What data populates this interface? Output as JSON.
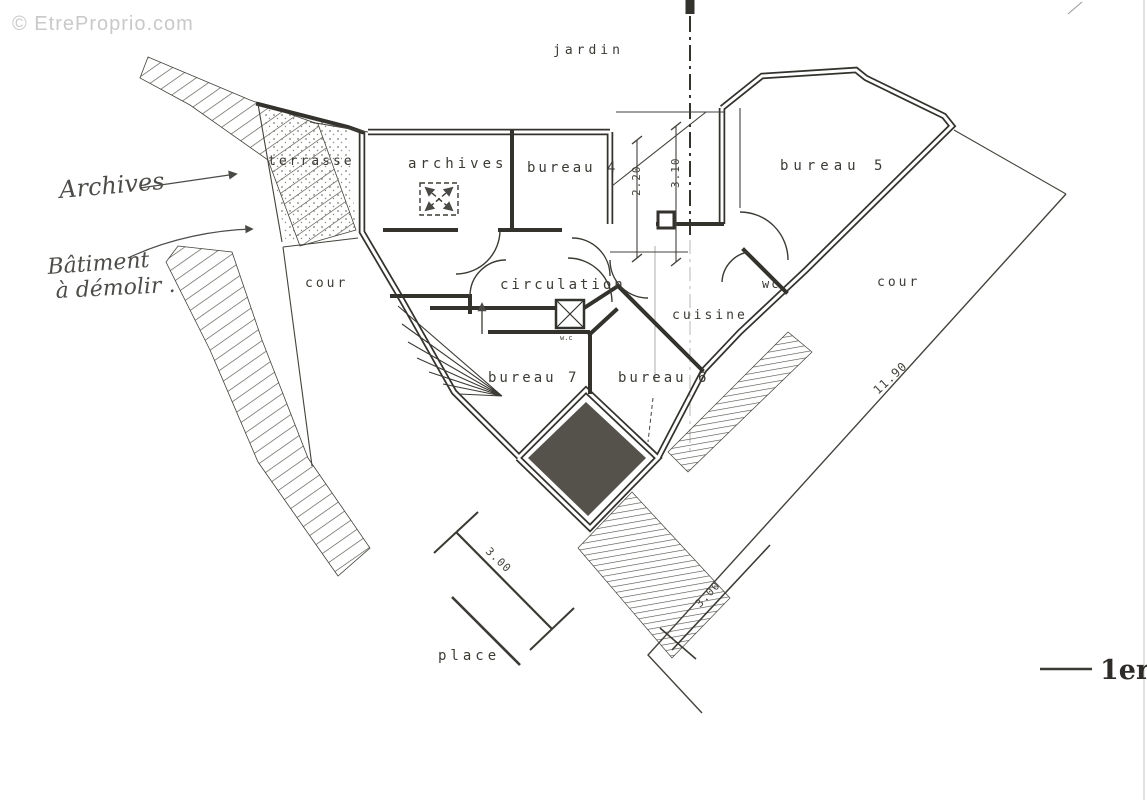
{
  "watermark": "© EtreProprio.com",
  "sheet": {
    "label": "1er"
  },
  "plan": {
    "rooms": {
      "jardin": "jardin",
      "terrasse": "terrasse",
      "archives": "archives",
      "bureau4": "bureau 4",
      "bureau5": "bureau  5",
      "cour_left": "cour",
      "circulation": "circulation",
      "wc": "wc",
      "wc_small": "w.c",
      "cuisine": "cuisine",
      "cour_right": "cour",
      "bureau7": "bureau 7",
      "bureau6": "bureau 6",
      "place": "place"
    },
    "dimensions": {
      "d220": "2.20",
      "d310": "3.10",
      "d1190": "11.90",
      "d300_left": "3.00",
      "d300_right": "3.00"
    },
    "annotations": {
      "archives_note": "Archives",
      "demolir_line1": "Bâtiment",
      "demolir_line2": "à démolir ."
    }
  },
  "colors": {
    "ink": "#34322d",
    "paper": "#ffffff",
    "watermark": "#c9c9c9",
    "dark_fill": "#55524c",
    "hatch": "#55524a"
  }
}
